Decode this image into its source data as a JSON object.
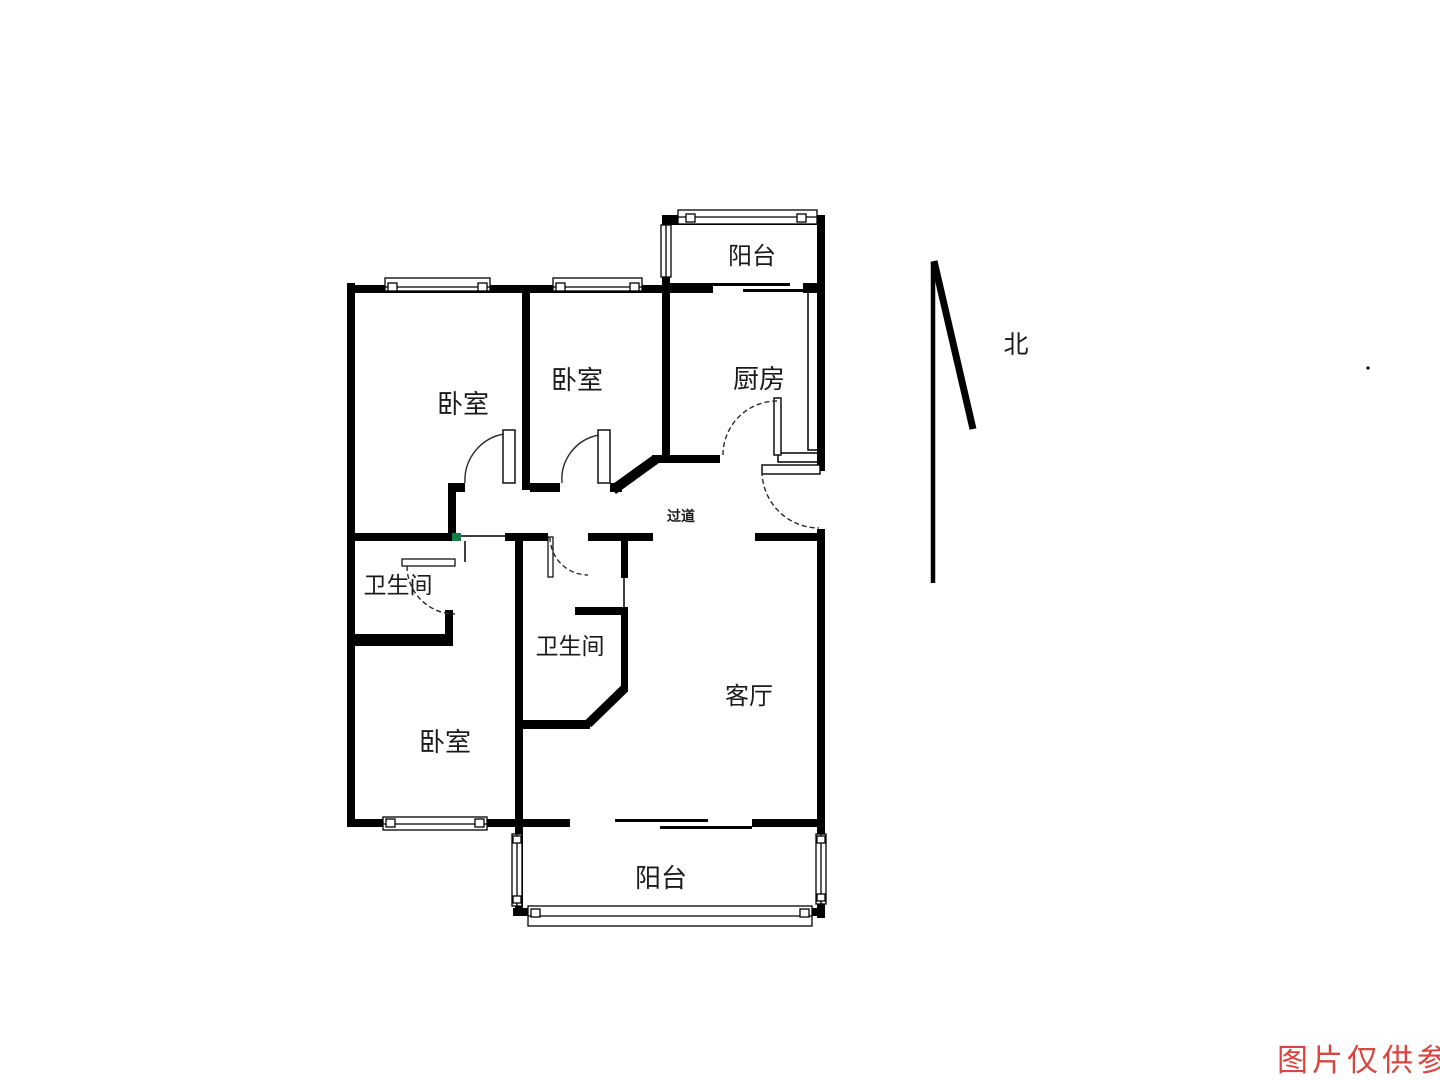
{
  "floorplan": {
    "rooms": {
      "balcony_top": "阳台",
      "bedroom_top_left": "卧室",
      "bedroom_top_mid": "卧室",
      "kitchen": "厨房",
      "hallway": "过道",
      "bathroom_left": "卫生间",
      "bathroom_mid": "卫生间",
      "living_room": "客厅",
      "bedroom_bottom": "卧室",
      "balcony_bottom": "阳台"
    },
    "compass_label": "北",
    "watermark": {
      "text": "图片仅供参考",
      "color": "#d9453f"
    },
    "colors": {
      "wall": "#000000",
      "background": "#ffffff",
      "marker_green": "#1b7a4a"
    }
  }
}
